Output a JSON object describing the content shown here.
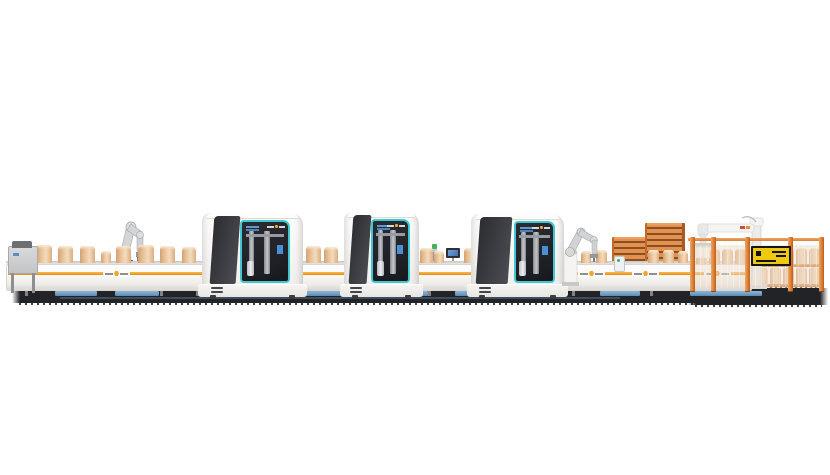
{
  "colors": {
    "accent_orange": "#f2a430",
    "accent_orange_dark": "#d8891c",
    "teal": "#3fc8d1",
    "machine_dark_a": "#2c2d31",
    "machine_dark_b": "#4b4d52",
    "window_bg": "#202227",
    "box_light": "#f3dbbd",
    "box_mid": "#e7c096",
    "box_shade": "#d3a273",
    "pallet_light": "#e2914f",
    "pallet_dark": "#8a4f22",
    "fence_orange": "#dd7e36",
    "sign_yellow": "#eec90f",
    "robot_gray": "#d2d3d5",
    "shadow_dark": "#222327",
    "bin_blue": "#6f9ec6",
    "screen_blue": "#4a8fd4",
    "signal_green": "#46b05a"
  },
  "scene": {
    "conveyor": {
      "x": 6,
      "top_y": 261,
      "face_y": 264,
      "face_h": 25,
      "w": 744,
      "stripe_y": 272,
      "stripe_h": 3,
      "logo_x": [
        103,
        578,
        632,
        704
      ],
      "legs_x": [
        25,
        70,
        160,
        196,
        312,
        332,
        428,
        468,
        572,
        606,
        650
      ],
      "bins": [
        {
          "x": 55,
          "w": 42
        },
        {
          "x": 115,
          "w": 44
        },
        {
          "x": 298,
          "w": 46
        },
        {
          "x": 388,
          "w": 40
        },
        {
          "x": 455,
          "w": 30
        },
        {
          "x": 520,
          "w": 44
        },
        {
          "x": 600,
          "w": 40
        },
        {
          "x": 690,
          "w": 72
        }
      ]
    },
    "boxes": [
      {
        "x": 14,
        "w": 16,
        "h": 18
      },
      {
        "x": 36,
        "w": 16,
        "h": 18
      },
      {
        "x": 58,
        "w": 15,
        "h": 17
      },
      {
        "x": 80,
        "w": 15,
        "h": 17
      },
      {
        "x": 101,
        "w": 10,
        "h": 12
      },
      {
        "x": 116,
        "w": 15,
        "h": 17
      },
      {
        "x": 138,
        "w": 16,
        "h": 18
      },
      {
        "x": 160,
        "w": 15,
        "h": 17
      },
      {
        "x": 182,
        "w": 14,
        "h": 16
      },
      {
        "x": 306,
        "w": 15,
        "h": 17
      },
      {
        "x": 324,
        "w": 14,
        "h": 16
      },
      {
        "x": 420,
        "w": 13,
        "h": 15
      },
      {
        "x": 434,
        "w": 10,
        "h": 12
      },
      {
        "x": 464,
        "w": 13,
        "h": 15
      },
      {
        "x": 565,
        "w": 12,
        "h": 14
      },
      {
        "x": 581,
        "w": 10,
        "h": 12
      },
      {
        "x": 596,
        "w": 11,
        "h": 13
      },
      {
        "x": 648,
        "w": 11,
        "h": 13
      },
      {
        "x": 663,
        "w": 11,
        "h": 13
      },
      {
        "x": 678,
        "w": 10,
        "h": 12
      }
    ],
    "machines": [
      {
        "x": 202,
        "y": 213,
        "w": 101,
        "h": 84,
        "dark_left": 10,
        "dark_w": 26,
        "win_left": 38,
        "win_right": 13
      },
      {
        "x": 344,
        "y": 212,
        "w": 75,
        "h": 85,
        "dark_left": 9,
        "dark_w": 24,
        "win_left": 36,
        "win_right": 12
      },
      {
        "x": 471,
        "y": 214,
        "w": 93,
        "h": 83,
        "dark_left": 8,
        "dark_w": 34,
        "win_left": 46,
        "win_right": 10
      }
    ],
    "stacks": [
      {
        "x": 612,
        "y": 237,
        "w": 32,
        "h": 52
      },
      {
        "x": 645,
        "y": 223,
        "w": 35,
        "h": 66
      }
    ],
    "fence": {
      "rail": {
        "x": 688,
        "y": 238,
        "w": 136
      },
      "posts_x": [
        690,
        711,
        745,
        788,
        819
      ],
      "post_y": 237,
      "post_h": 55,
      "panel_y": 245,
      "panel_h": 43,
      "sign": {
        "x": 751,
        "y": 246,
        "w": 36,
        "h": 16
      }
    },
    "goods": {
      "row1": {
        "y": 249,
        "h": 15,
        "w": 11,
        "xs": [
          696,
          709,
          722,
          735
        ]
      },
      "block_tier1": {
        "y": 248,
        "h": 16,
        "w": 11,
        "xs": [
          757,
          770,
          783,
          796,
          809
        ]
      },
      "block_tier2": {
        "y": 267,
        "h": 17,
        "w": 11,
        "xs": [
          757,
          770,
          783,
          796,
          809
        ]
      },
      "pallet_lines": [
        {
          "x": 755,
          "y": 264,
          "w": 64
        },
        {
          "x": 755,
          "y": 284,
          "w": 64
        }
      ]
    },
    "shadow": {
      "main": {
        "x": 12,
        "y": 288,
        "w": 700,
        "h": 15
      },
      "right": {
        "x": 688,
        "y": 288,
        "w": 140,
        "h": 17
      },
      "blue_line": {
        "x": 60,
        "y": 297,
        "w": 560
      }
    }
  }
}
